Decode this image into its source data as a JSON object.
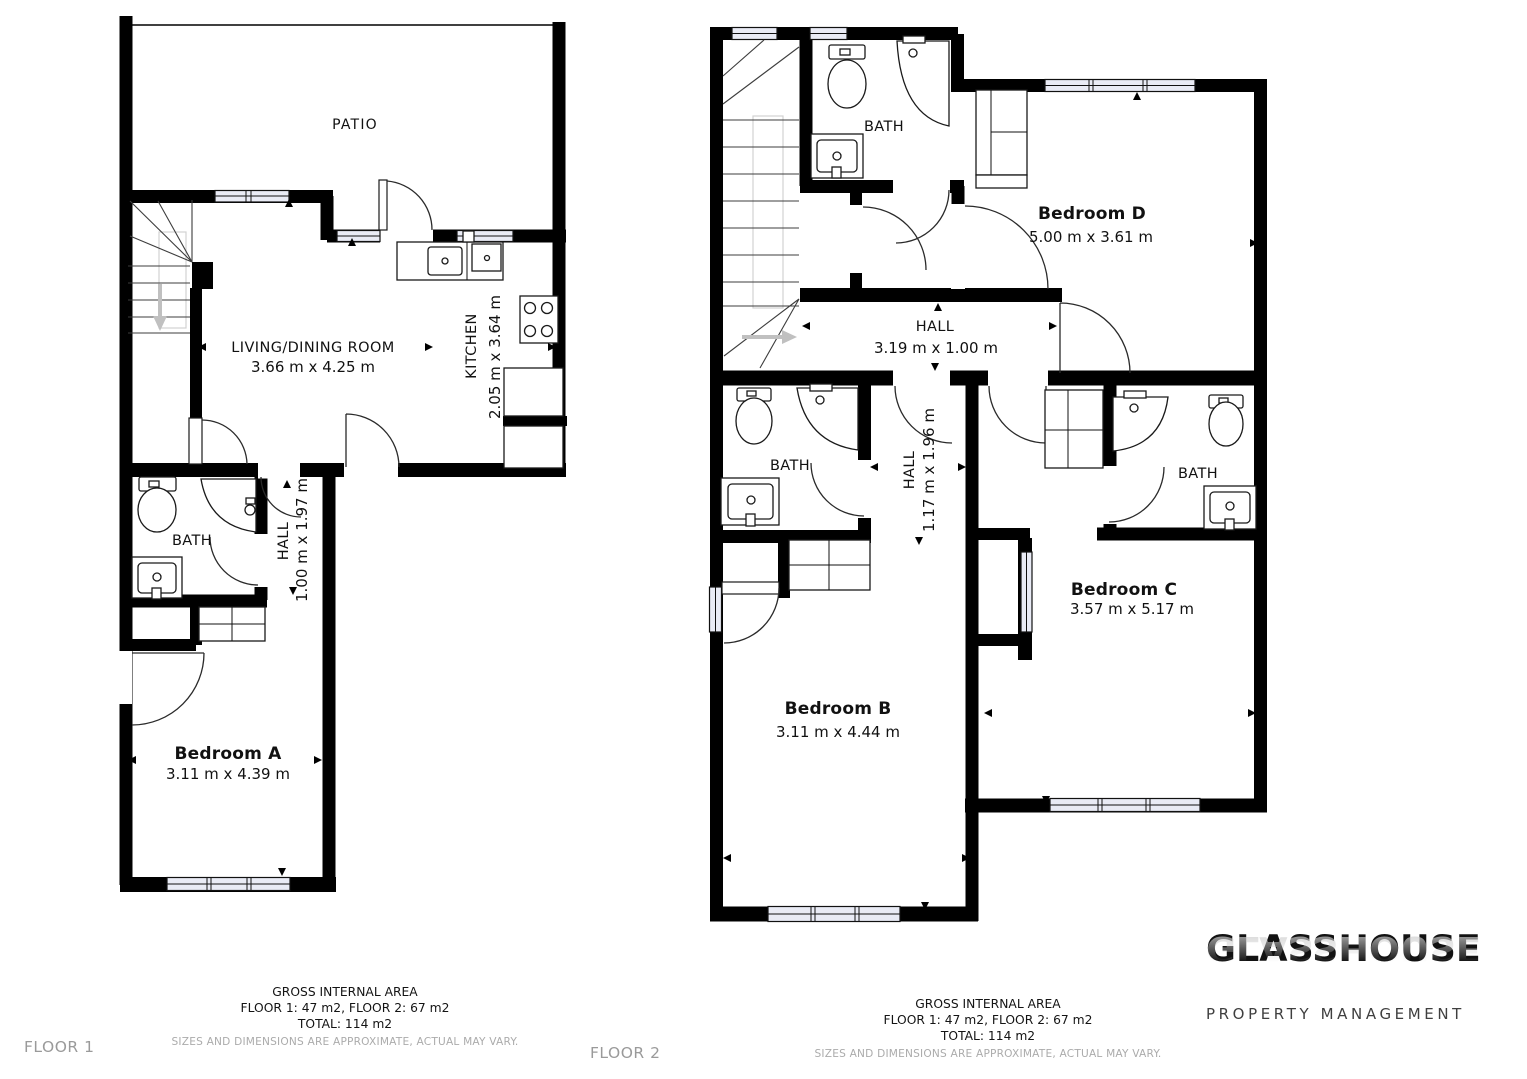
{
  "floor1": {
    "floor_label": "FLOOR 1",
    "patio": {
      "label": "PATIO"
    },
    "living_dining": {
      "label": "LIVING/DINING ROOM",
      "dims": "3.66 m x 4.25 m"
    },
    "kitchen": {
      "label": "KITCHEN",
      "dims": "2.05 m x 3.64 m"
    },
    "bath": {
      "label": "BATH"
    },
    "hall": {
      "label": "HALL",
      "dims": "1.00 m x 1.97 m"
    },
    "bedroom_a": {
      "label": "Bedroom A",
      "dims": "3.11 m x 4.39 m"
    }
  },
  "floor2": {
    "floor_label": "FLOOR 2",
    "bath_top": {
      "label": "BATH"
    },
    "bedroom_d": {
      "label": "Bedroom D",
      "dims": "5.00 m x 3.61 m"
    },
    "hall": {
      "label": "HALL",
      "dims": "3.19 m x 1.00 m"
    },
    "bath_left": {
      "label": "BATH"
    },
    "hall_inner": {
      "label": "HALL",
      "dims": "1.17 m x 1.96 m"
    },
    "bath_right": {
      "label": "BATH"
    },
    "bedroom_c": {
      "label": "Bedroom C",
      "dims": "3.57 m x 5.17 m"
    },
    "bedroom_b": {
      "label": "Bedroom B",
      "dims": "3.11 m x 4.44 m"
    }
  },
  "footer": {
    "title": "GROSS INTERNAL AREA",
    "floors_line": "FLOOR 1: 47 m2, FLOOR 2: 67 m2",
    "total_line": "TOTAL: 114 m2",
    "disclaimer": "SIZES AND DIMENSIONS ARE APPROXIMATE, ACTUAL MAY VARY."
  },
  "logo": {
    "name": "GLASSHOUSE",
    "subtitle": "PROPERTY MANAGEMENT"
  },
  "colors": {
    "wall": "#000000",
    "window_fill": "#e9ebf5",
    "muted_text": "#9a9a9a"
  }
}
